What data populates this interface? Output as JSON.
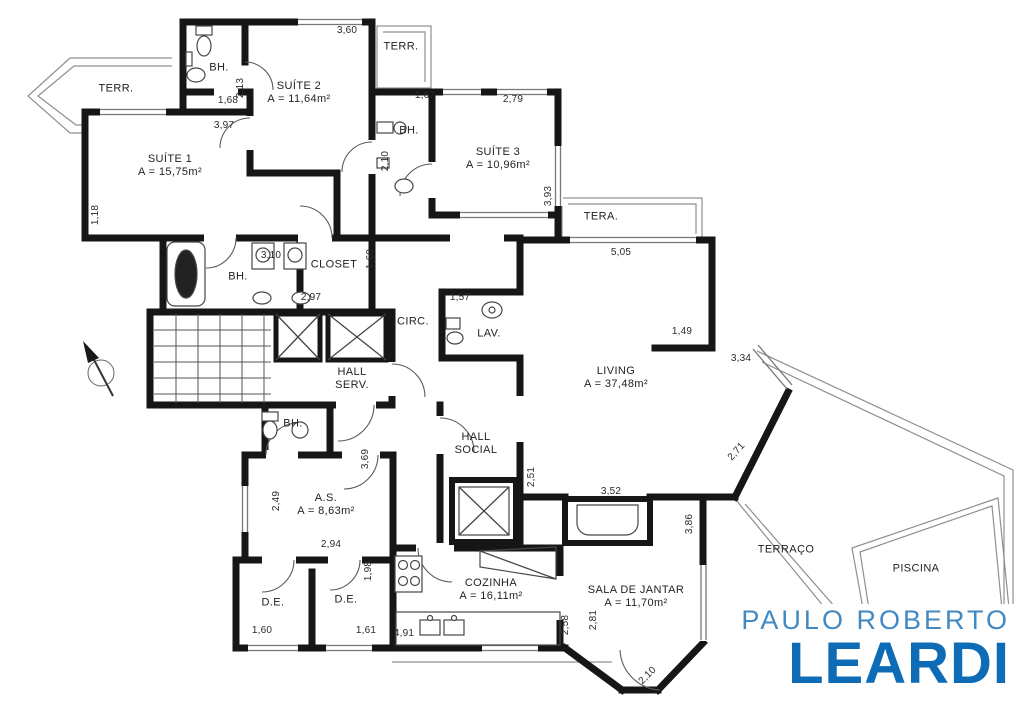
{
  "rooms": {
    "terr_nw": {
      "name": "TERR."
    },
    "suite1": {
      "name": "SUÍTE 1",
      "area": "A = 15,75m²"
    },
    "bh_suite2": {
      "name": "BH."
    },
    "suite2": {
      "name": "SUÍTE 2",
      "area": "A = 11,64m²"
    },
    "terr_top": {
      "name": "TERR."
    },
    "bh_suite3": {
      "name": "BH."
    },
    "suite3": {
      "name": "SUÍTE 3",
      "area": "A = 10,96m²"
    },
    "tera": {
      "name": "TERA."
    },
    "bh_master": {
      "name": "BH."
    },
    "closet": {
      "name": "CLOSET"
    },
    "circ": {
      "name": "CIRC."
    },
    "lav": {
      "name": "LAV."
    },
    "living": {
      "name": "LIVING",
      "area": "A = 37,48m²"
    },
    "hall_serv": {
      "line1": "HALL",
      "line2": "SERV."
    },
    "hall_social": {
      "line1": "HALL",
      "line2": "SOCIAL"
    },
    "bh_as": {
      "name": "BH."
    },
    "as": {
      "name": "A.S.",
      "area": "A = 8,63m²"
    },
    "de1": {
      "name": "D.E."
    },
    "de2": {
      "name": "D.E."
    },
    "cozinha": {
      "name": "COZINHA",
      "area": "A = 16,11m²"
    },
    "sala_jantar": {
      "name": "SALA DE JANTAR",
      "area": "A = 11,70m²"
    },
    "terraco": {
      "name": "TERRAÇO"
    },
    "piscina": {
      "name": "PISCINA"
    }
  },
  "dims": {
    "suite2_top": "3,60",
    "bh_suite2_w": "1,68",
    "bh_suite2_h": "2,13",
    "suite2_w": "3,97",
    "bh_suite3_w": "1,67",
    "suite3_w": "2,79",
    "bh_suite3_h": "2,10",
    "suite3_h": "3,93",
    "suite1_h": "1,18",
    "bh_master_w": "3,10",
    "bh_master_w2": "2,97",
    "closet_h": "1,60",
    "lav_w": "1,57",
    "living_top": "5,05",
    "living_right_w": "1,49",
    "living_right_w2": "3,34",
    "living_diag": "2,71",
    "banco_w": "3,52",
    "sala_right_h": "3,86",
    "hall_social_h": "2,51",
    "as_right_h": "3,69",
    "as_left_h": "2,49",
    "as_w": "2,94",
    "de2_h": "1,98",
    "de1_w": "1,60",
    "de2_w": "1,61",
    "cozinha_w": "4,91",
    "sala_h1": "2,58",
    "sala_h2": "2,81",
    "sala_diag": "2,10"
  },
  "icons": {
    "north_arrow": "north-arrow"
  },
  "logo": {
    "line1": "PAULO ROBERTO",
    "line2": "LEARDI",
    "brand_blue": "#0d6cb5",
    "brand_blue_light": "#4289c2"
  }
}
